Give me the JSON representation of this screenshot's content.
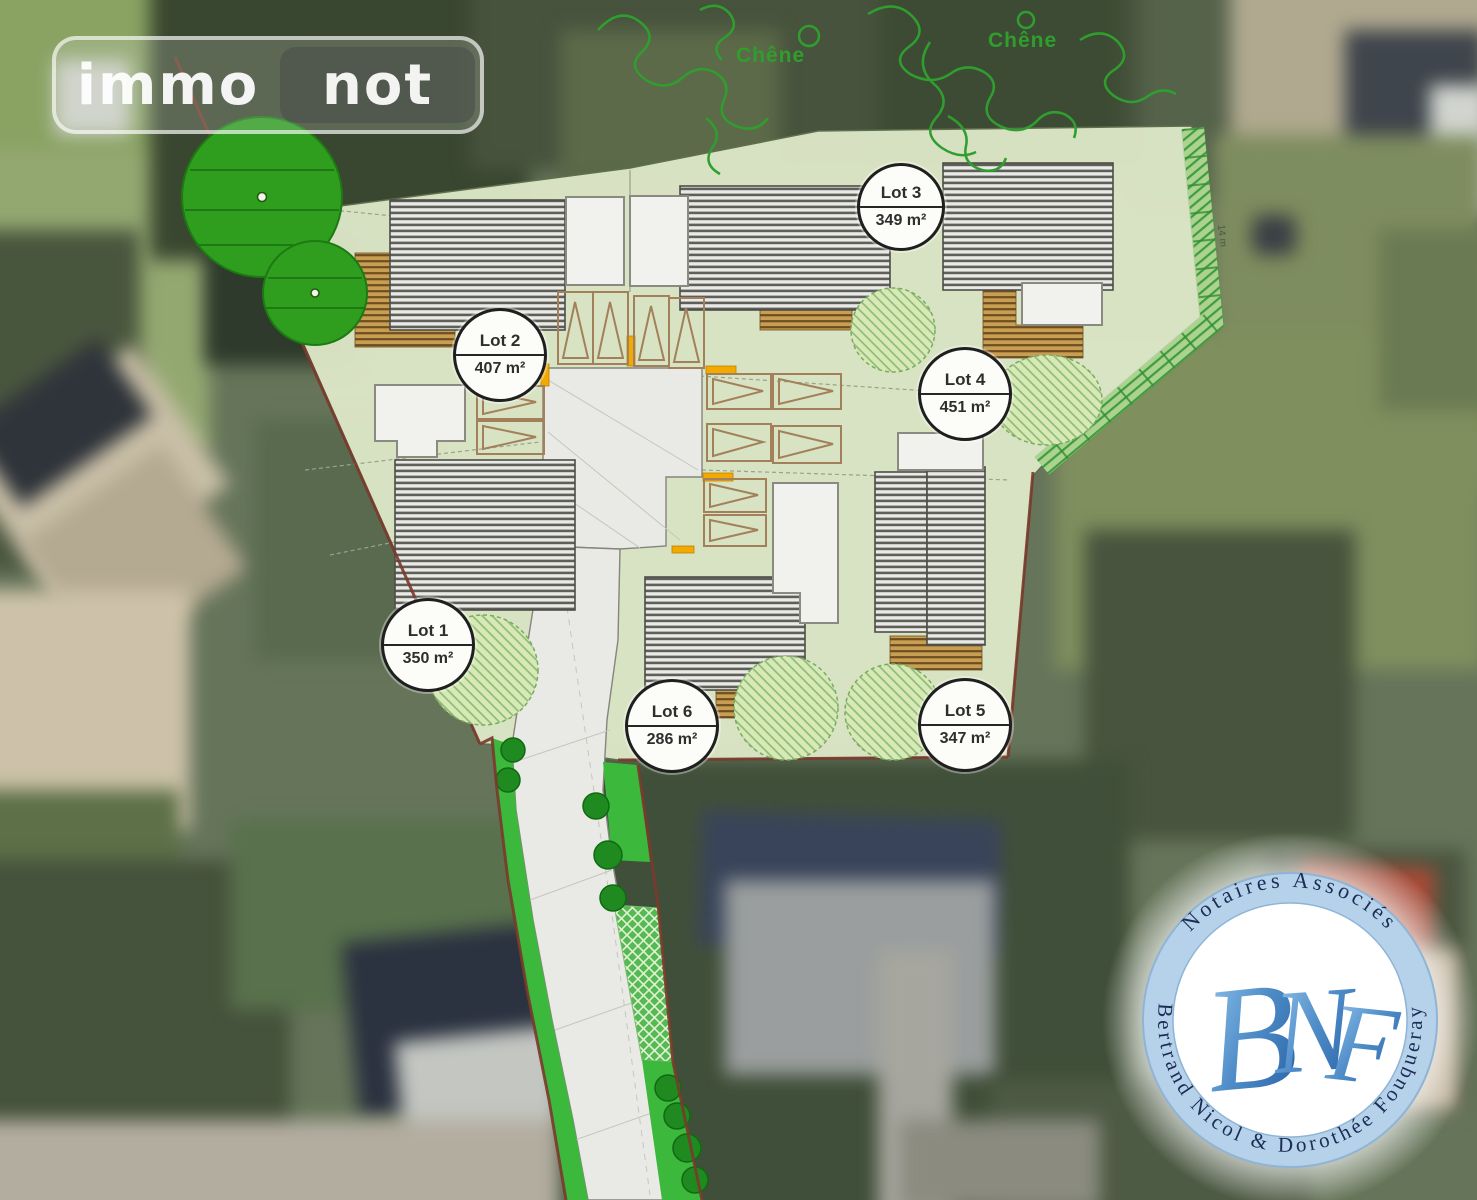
{
  "watermark": {
    "segment_primary": "immo",
    "segment_secondary": "not"
  },
  "site_plan": {
    "lots": [
      {
        "label": "Lot 1",
        "area": "350 m²"
      },
      {
        "label": "Lot 2",
        "area": "407 m²"
      },
      {
        "label": "Lot 3",
        "area": "349 m²"
      },
      {
        "label": "Lot 4",
        "area": "451 m²"
      },
      {
        "label": "Lot 5",
        "area": "347 m²"
      },
      {
        "label": "Lot 6",
        "area": "286 m²"
      }
    ],
    "tree_labels": {
      "left": "Chêne",
      "right": "Chêne"
    },
    "hedge_measurement": "14 m",
    "colors": {
      "plan_ground": "#dde7c8",
      "tree_canopy": "#2f9e1f",
      "boundary": "#7a3a2c",
      "access_marker": "#f2a900",
      "road": "#e9e9e6"
    }
  },
  "notary_seal": {
    "arc_top": "Notaires Associés",
    "arc_bottom": "Bertrand Nicol & Dorothée Fouqueray",
    "monogram": [
      "B",
      "N",
      "F"
    ],
    "colors": {
      "ring": "#b5d2ea",
      "text": "#1c2c55",
      "monogram": "#3f7cc0"
    }
  }
}
